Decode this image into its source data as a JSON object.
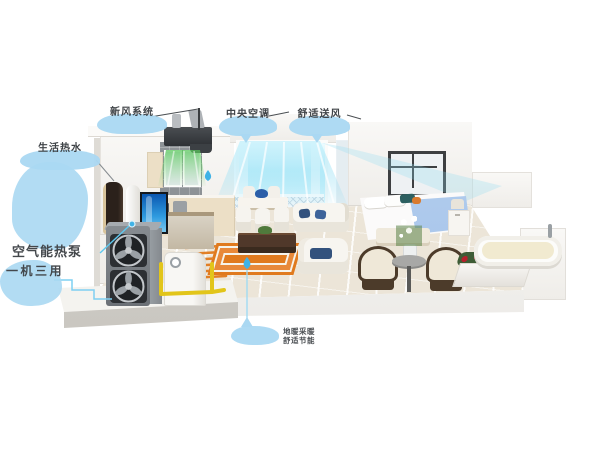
{
  "labels": {
    "fresh_air": {
      "text": "新风系统"
    },
    "central_ac": {
      "text": "中央空调"
    },
    "comfort_air": {
      "text": "舒适送风"
    },
    "hot_water": {
      "text": "生活热水"
    },
    "heat_pump": {
      "line1": "空气能热泵",
      "line2": "一机三用"
    },
    "floor_heating": {
      "line1": "地暖采暖",
      "line2": "舒适节能"
    }
  },
  "icons": {
    "fresh_air_marker": "water-drop",
    "floor_heating_marker": "water-drop",
    "heat_pump_marker": "blue-dot"
  },
  "colors": {
    "callout_bubble": "#aad8f2",
    "callout_text": "#3f4347",
    "marker_blue": "#3fb2e6",
    "pipe_yellow": "#e2c51a",
    "floor_coil_orange": "#e0791c",
    "fresh_air_green": "#57c75a",
    "ac_air_cyan": "#9fe2f5",
    "outdoor_unit_gray": "#7e8287",
    "rug_orange": "#e07a1e",
    "bed_blue": "#a9c6ec",
    "flower_red": "#b5202c"
  }
}
